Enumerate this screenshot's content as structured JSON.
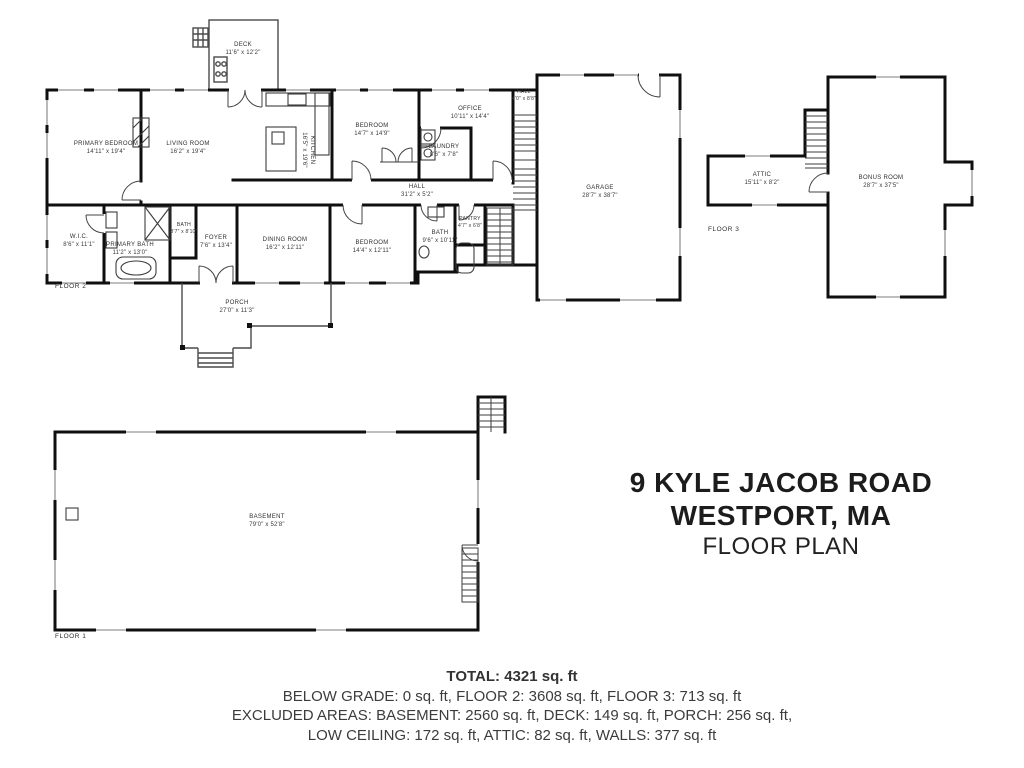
{
  "title": {
    "address_line1": "9 KYLE JACOB ROAD",
    "address_line2": "WESTPORT, MA",
    "subtitle": "FLOOR PLAN"
  },
  "summary": {
    "total": "TOTAL: 4321 sq. ft",
    "grades": "BELOW GRADE: 0 sq. ft, FLOOR 2: 3608 sq. ft, FLOOR 3: 713 sq. ft",
    "excluded1": "EXCLUDED AREAS: BASEMENT: 2560 sq. ft, DECK: 149 sq. ft, PORCH: 256 sq. ft,",
    "excluded2": "LOW CEILING: 172 sq. ft, ATTIC: 82 sq. ft, WALLS: 377 sq. ft"
  },
  "floor2": {
    "label": "FLOOR 2",
    "rooms": {
      "deck": {
        "name": "DECK",
        "dims": "11'6\" x 12'2\""
      },
      "primary_bedroom": {
        "name": "PRIMARY BEDROOM",
        "dims": "14'11\" x 19'4\""
      },
      "living_room": {
        "name": "LIVING ROOM",
        "dims": "16'2\" x 19'4\""
      },
      "kitchen": {
        "name": "KITCHEN",
        "dims": "16'5\" x 19'6\""
      },
      "bedroom_top": {
        "name": "BEDROOM",
        "dims": "14'7\" x 14'9\""
      },
      "office": {
        "name": "OFFICE",
        "dims": "10'11\" x 14'4\""
      },
      "laundry": {
        "name": "LAUNDRY",
        "dims": "8'6\" x 7'8\""
      },
      "hall": {
        "name": "HALL",
        "dims": "31'2\" x 5'2\""
      },
      "hall_small": {
        "name": "HALL",
        "dims": "4'0\" x 8'8\""
      },
      "garage": {
        "name": "GARAGE",
        "dims": "28'7\" x 38'7\""
      },
      "wic": {
        "name": "W.I.C.",
        "dims": "8'6\" x 11'1\""
      },
      "primary_bath": {
        "name": "PRIMARY BATH",
        "dims": "11'2\" x 13'0\""
      },
      "bath_small": {
        "name": "BATH",
        "dims": "3'7\" x 8'10\""
      },
      "foyer": {
        "name": "FOYER",
        "dims": "7'6\" x 13'4\""
      },
      "dining_room": {
        "name": "DINING ROOM",
        "dims": "16'2\" x 12'11\""
      },
      "bedroom_bottom": {
        "name": "BEDROOM",
        "dims": "14'4\" x 12'11\""
      },
      "bath": {
        "name": "BATH",
        "dims": "9'6\" x 10'11\""
      },
      "pantry": {
        "name": "PANTRY",
        "dims": "4'7\" x 6'8\""
      },
      "porch": {
        "name": "PORCH",
        "dims": "27'0\" x 11'3\""
      }
    }
  },
  "floor3": {
    "label": "FLOOR 3",
    "rooms": {
      "attic": {
        "name": "ATTIC",
        "dims": "15'11\" x 8'2\""
      },
      "bonus_room": {
        "name": "BONUS ROOM",
        "dims": "28'7\" x 37'5\""
      }
    }
  },
  "floor1": {
    "label": "FLOOR 1",
    "rooms": {
      "basement": {
        "name": "BASEMENT",
        "dims": "79'0\" x 52'8\""
      }
    }
  },
  "colors": {
    "walls": "#0f0f0f",
    "text": "#2f2f2f",
    "window_gray": "#a8a8a8"
  }
}
